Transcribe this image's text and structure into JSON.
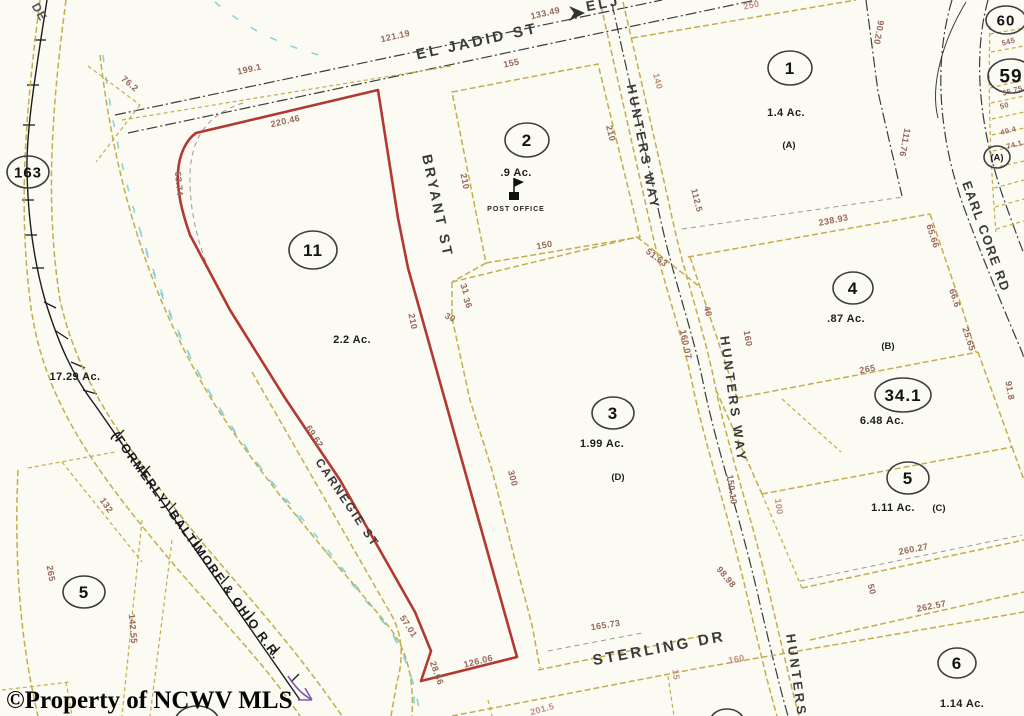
{
  "watermark": "©Property of NCWV MLS",
  "route_marker": "163",
  "corner_text": "DE",
  "railroad": {
    "name": "(FORMERLY) BALTIMORE & OHIO R.R."
  },
  "streets": {
    "el_jadid": "EL JADID ST",
    "el_jadid_cont": "ELJ",
    "bryant": "BRYANT ST",
    "hunters_upper": "HUNTERS WAY",
    "hunters_mid": "HUNTERS WAY",
    "hunters_lower": "HUNTERS",
    "carnegie": "CARNEGIE ST",
    "sterling": "STERLING DR",
    "earl_core": "EARL CORE RD"
  },
  "parcels": {
    "p11": {
      "num": "11",
      "ac": "2.2 Ac."
    },
    "p2": {
      "num": "2",
      "ac": ".9 Ac.",
      "poi": "POST OFFICE"
    },
    "p1": {
      "num": "1",
      "ac": "1.4 Ac.",
      "sub": "(A)"
    },
    "p4": {
      "num": "4",
      "ac": ".87 Ac.",
      "sub": "(B)"
    },
    "p341": {
      "num": "34.1",
      "ac": "6.48 Ac."
    },
    "p5e": {
      "num": "5",
      "ac": "1.11 Ac.",
      "sub": "(C)"
    },
    "p3": {
      "num": "3",
      "ac": "1.99 Ac.",
      "sub": "(D)"
    },
    "p6": {
      "num": "6",
      "ac": "1.14 Ac."
    },
    "p5w": {
      "num": "5"
    },
    "p60": {
      "num": "60"
    },
    "p59": {
      "num": "59"
    },
    "pA": {
      "num": "(A)"
    },
    "tract": {
      "ac": "17.29 Ac."
    }
  },
  "dims": [
    "133.49",
    "121.19",
    "199.1",
    "76.2",
    "155",
    "250",
    "140",
    "90.20",
    "220.46",
    "63.74",
    "210",
    "210",
    "210",
    "150",
    "51.63",
    "112.5",
    "111.76",
    "238.93",
    "65.66",
    "31",
    "36",
    "30",
    "300",
    "160.07",
    "40",
    "66.6",
    "25.65",
    "265",
    "91.8",
    "160",
    "100",
    "150.10",
    "98.98",
    "165.73",
    "260.27",
    "50",
    "262.57",
    "201.5",
    "15",
    "160",
    "57.01",
    "28.66",
    "126.06",
    "69.62",
    "265",
    "142.55",
    "132",
    "545",
    "35.75",
    "50",
    "40.4",
    "74.1"
  ],
  "colors": {
    "subject_outline": "#b23830",
    "parcel_line": "#c2ae4c",
    "road_line": "#3c3c3c",
    "water": "#8ad3de",
    "dim_text": "#96685c"
  }
}
